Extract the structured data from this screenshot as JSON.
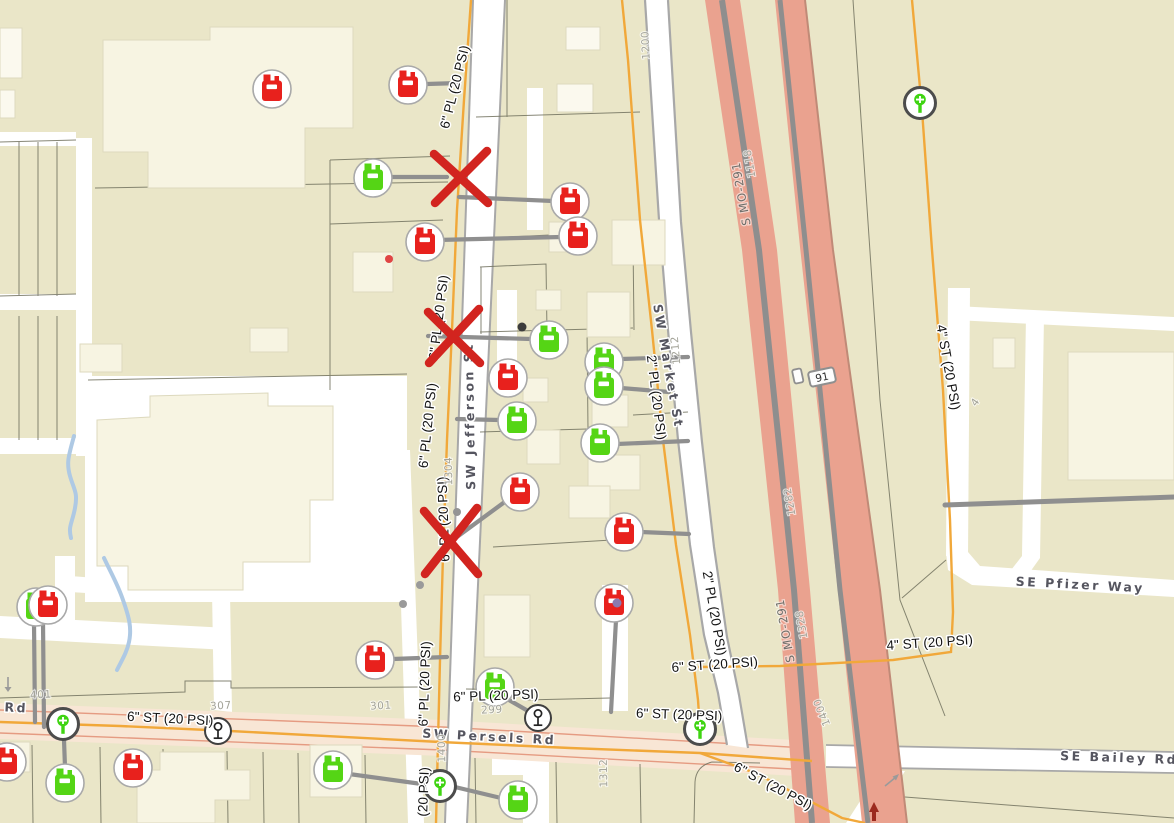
{
  "map": {
    "canvas": {
      "width": 1174,
      "height": 823,
      "background": "#eae6c8"
    },
    "colors": {
      "meter_red": "#e8211d",
      "meter_green": "#55d515",
      "valve_green": "#3fd412",
      "x_mark_red": "#d2241f",
      "pipe_orange": "#f1a83a",
      "service_gray": "#8f8f8f",
      "highway_fill": "#eaa28f",
      "road_band_fill": "#f8e6d5"
    },
    "labels": {
      "streets": [
        {
          "text": "SW Jefferson St",
          "x": 474,
          "y": 416,
          "rot": -91
        },
        {
          "text": "SW Market St",
          "x": 664,
          "y": 367,
          "rot": 80
        },
        {
          "text": "SW Persels Rd",
          "x": 489,
          "y": 741,
          "rot": 3
        },
        {
          "text": "Rd",
          "x": 16,
          "y": 712,
          "rot": 3
        },
        {
          "text": "SE Pfizer Way",
          "x": 1080,
          "y": 589,
          "rot": 3
        },
        {
          "text": "SE Bailey Rd",
          "x": 1119,
          "y": 762,
          "rot": 2
        }
      ],
      "highways": [
        {
          "text": "S MO-291",
          "x": 745,
          "y": 193,
          "rot": -100
        },
        {
          "text": "S MO-291",
          "x": 789,
          "y": 630,
          "rot": -100
        }
      ],
      "pipes": [
        {
          "text": "6\" PL (20 PSI)",
          "x": 459,
          "y": 88,
          "rot": -76
        },
        {
          "text": "6\" PL (20 PSI)",
          "x": 443,
          "y": 318,
          "rot": -83
        },
        {
          "text": "6\" PL (20 PSI)",
          "x": 432,
          "y": 426,
          "rot": -84
        },
        {
          "text": "6\" PL (20 PSI)",
          "x": 448,
          "y": 519,
          "rot": -92
        },
        {
          "text": "6\" PL (20 PSI)",
          "x": 429,
          "y": 684,
          "rot": -88
        },
        {
          "text": "(20 PSI)",
          "x": 428,
          "y": 792,
          "rot": -88
        },
        {
          "text": "6\" PL (20 PSI)",
          "x": 496,
          "y": 700,
          "rot": -2
        },
        {
          "text": "2\" PL (20 PSI)",
          "x": 652,
          "y": 398,
          "rot": 83
        },
        {
          "text": "2\" PL (20 PSI)",
          "x": 710,
          "y": 614,
          "rot": 80
        },
        {
          "text": "6\" ST (20 PSI)",
          "x": 170,
          "y": 723,
          "rot": 3
        },
        {
          "text": "6\" ST (20 PSI)",
          "x": 679,
          "y": 719,
          "rot": 2
        },
        {
          "text": "6\" ST (20 PSI)",
          "x": 715,
          "y": 669,
          "rot": -4
        },
        {
          "text": "6\" ST (20 PSI)",
          "x": 771,
          "y": 790,
          "rot": 28
        },
        {
          "text": "4\" ST (20 PSI)",
          "x": 930,
          "y": 647,
          "rot": -4
        },
        {
          "text": "4\" ST (20 PSI)",
          "x": 944,
          "y": 368,
          "rot": 80
        }
      ],
      "addresses": [
        {
          "text": "1200",
          "x": 649,
          "y": 45,
          "rot": -93
        },
        {
          "text": "1118",
          "x": 753,
          "y": 163,
          "rot": -100
        },
        {
          "text": "1212",
          "x": 679,
          "y": 350,
          "rot": -95
        },
        {
          "text": "1304",
          "x": 452,
          "y": 471,
          "rot": -91
        },
        {
          "text": "1282",
          "x": 793,
          "y": 501,
          "rot": -100
        },
        {
          "text": "1328",
          "x": 805,
          "y": 624,
          "rot": -100
        },
        {
          "text": "1400",
          "x": 445,
          "y": 748,
          "rot": -91
        },
        {
          "text": "1400",
          "x": 825,
          "y": 711,
          "rot": -112
        },
        {
          "text": "1312",
          "x": 607,
          "y": 773,
          "rot": -91
        },
        {
          "text": "299",
          "x": 492,
          "y": 713,
          "rot": -3
        },
        {
          "text": "301",
          "x": 381,
          "y": 709,
          "rot": -3
        },
        {
          "text": "307",
          "x": 221,
          "y": 709,
          "rot": -3
        },
        {
          "text": "401",
          "x": 41,
          "y": 698,
          "rot": -3
        },
        {
          "text": "4",
          "x": 978,
          "y": 404,
          "rot": -55
        }
      ]
    },
    "route_shield": {
      "text": "91",
      "x": 822,
      "y": 377,
      "rot": -12
    },
    "icons": {
      "meters": [
        {
          "x": 272,
          "y": 89,
          "color": "red"
        },
        {
          "x": 408,
          "y": 85,
          "color": "red"
        },
        {
          "x": 373,
          "y": 178,
          "color": "green"
        },
        {
          "x": 570,
          "y": 202,
          "color": "red"
        },
        {
          "x": 425,
          "y": 242,
          "color": "red"
        },
        {
          "x": 578,
          "y": 236,
          "color": "red"
        },
        {
          "x": 549,
          "y": 340,
          "color": "green"
        },
        {
          "x": 604,
          "y": 362,
          "color": "green"
        },
        {
          "x": 508,
          "y": 378,
          "color": "red"
        },
        {
          "x": 604,
          "y": 386,
          "color": "green"
        },
        {
          "x": 517,
          "y": 421,
          "color": "green"
        },
        {
          "x": 600,
          "y": 443,
          "color": "green"
        },
        {
          "x": 520,
          "y": 492,
          "color": "red"
        },
        {
          "x": 624,
          "y": 532,
          "color": "red"
        },
        {
          "x": 614,
          "y": 603,
          "color": "red"
        },
        {
          "x": 375,
          "y": 660,
          "color": "red"
        },
        {
          "x": 495,
          "y": 687,
          "color": "green"
        },
        {
          "x": 36,
          "y": 607,
          "color": "green"
        },
        {
          "x": 48,
          "y": 605,
          "color": "red"
        },
        {
          "x": 7,
          "y": 762,
          "color": "red"
        },
        {
          "x": 65,
          "y": 783,
          "color": "green"
        },
        {
          "x": 133,
          "y": 768,
          "color": "red"
        },
        {
          "x": 333,
          "y": 770,
          "color": "green"
        },
        {
          "x": 518,
          "y": 800,
          "color": "green"
        }
      ],
      "valves": [
        {
          "x": 63,
          "y": 724
        },
        {
          "x": 700,
          "y": 729
        },
        {
          "x": 440,
          "y": 786
        },
        {
          "x": 920,
          "y": 103
        }
      ],
      "regulators": [
        {
          "x": 218,
          "y": 731
        },
        {
          "x": 538,
          "y": 718
        }
      ],
      "x_marks": [
        {
          "x": 462,
          "y": 177,
          "w": 56,
          "h": 52
        },
        {
          "x": 455,
          "y": 336,
          "w": 54,
          "h": 54
        },
        {
          "x": 452,
          "y": 541,
          "w": 56,
          "h": 66
        }
      ],
      "dots": [
        {
          "x": 389,
          "y": 259,
          "r": 4,
          "color": "#e04545"
        },
        {
          "x": 522,
          "y": 327,
          "r": 4.5,
          "color": "#3c3c3c"
        },
        {
          "x": 457,
          "y": 512,
          "r": 4,
          "color": "#949494"
        },
        {
          "x": 420,
          "y": 585,
          "r": 4,
          "color": "#9a9a9a"
        },
        {
          "x": 403,
          "y": 604,
          "r": 4,
          "color": "#9a9a9a"
        },
        {
          "x": 617,
          "y": 603,
          "r": 4.5,
          "color": "#8a7bb0"
        }
      ],
      "arrows": [
        {
          "type": "down-gray",
          "x": 8,
          "y": 685
        },
        {
          "type": "ne-gray",
          "x": 893,
          "y": 780
        },
        {
          "type": "up-red",
          "x": 874,
          "y": 812
        }
      ]
    }
  }
}
